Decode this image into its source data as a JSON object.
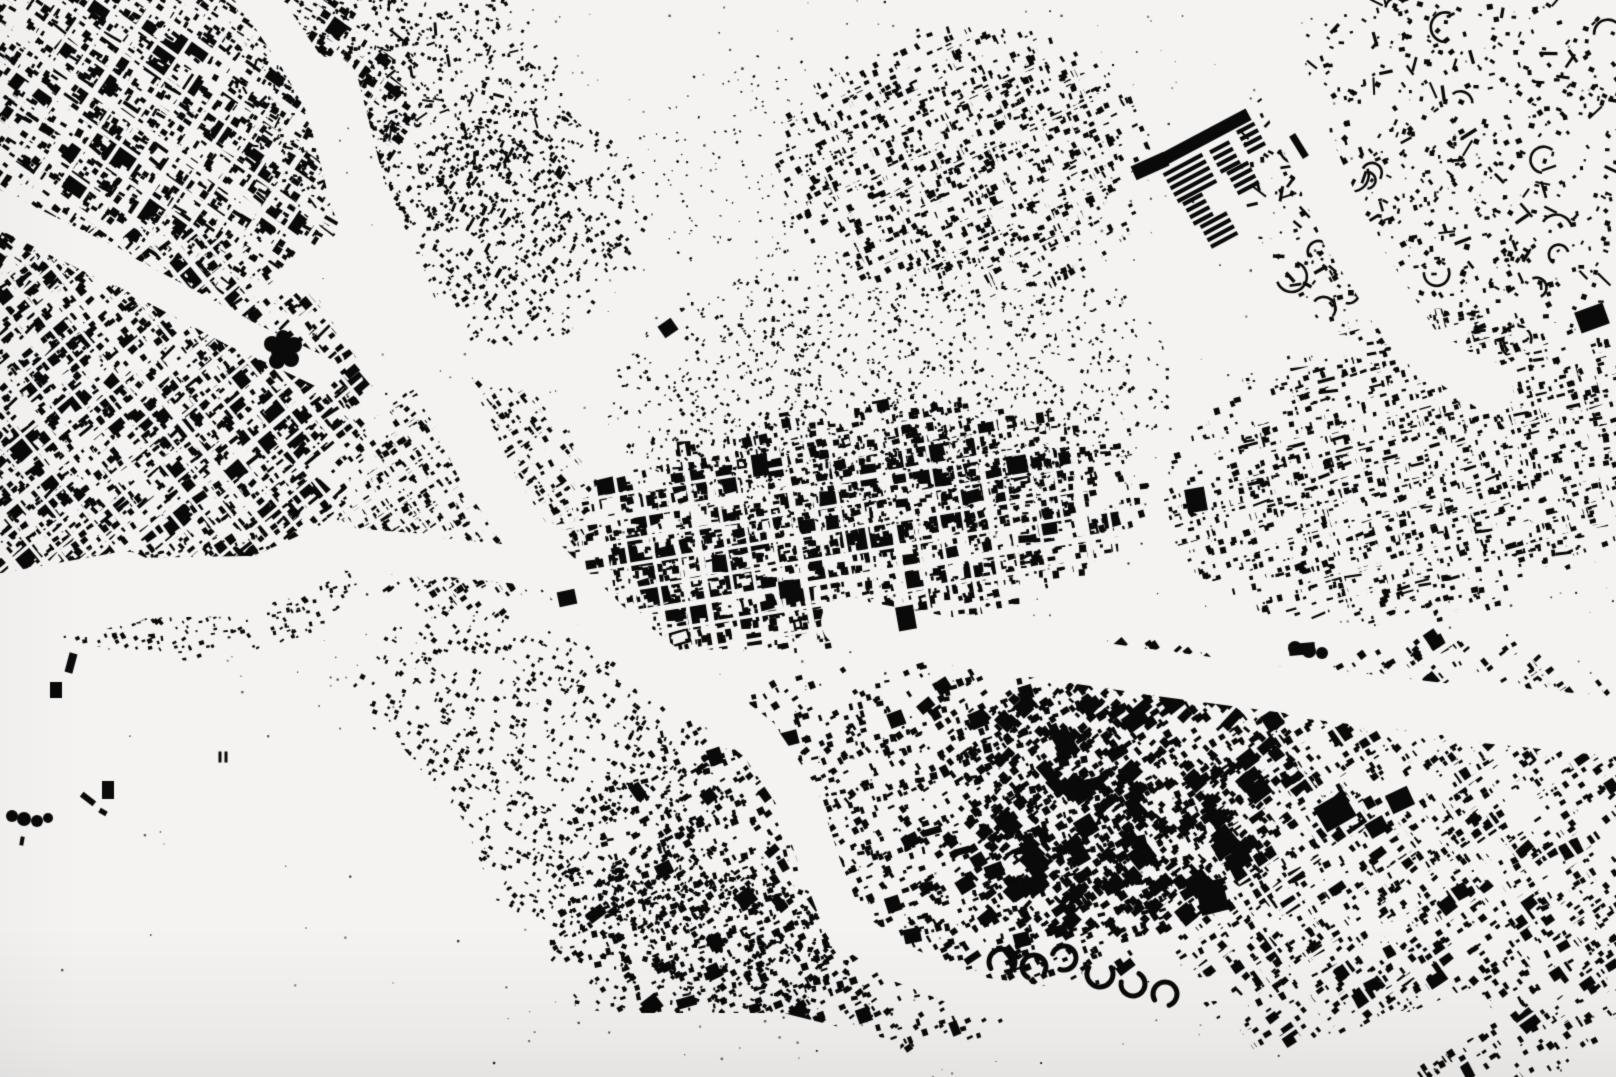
{
  "meta": {
    "content_type": "figure-ground-city-map",
    "visible_text": "none"
  },
  "canvas": {
    "width": 1616,
    "height": 1077
  },
  "colors": {
    "background": "#f4f3f2",
    "ink": "#0a0a0a"
  },
  "seed": 1337,
  "districts": [
    {
      "name": "old-town-northwest",
      "cx": 170,
      "cy": 115,
      "rx": 255,
      "ry": 180,
      "rot": -18,
      "angle": 35,
      "angle_jitter": 7,
      "count": 2300,
      "size_min": 2.5,
      "size_max": 8.5,
      "elong_chance": 0.1,
      "large_chance": 0.05,
      "large_size": 16,
      "streets": {
        "angles": [
          35,
          -55
        ],
        "spacing": 26,
        "width": 4,
        "main_every": 4,
        "main_width": 6.5
      }
    },
    {
      "name": "hillside-north",
      "cx": 400,
      "cy": 95,
      "rx": 170,
      "ry": 135,
      "rot": 15,
      "count": 1000,
      "size_min": 1.5,
      "size_max": 4.5,
      "elong_chance": 0.06
    },
    {
      "name": "old-town-west",
      "cx": 148,
      "cy": 425,
      "rx": 218,
      "ry": 198,
      "rot": 8,
      "angle": -40,
      "angle_jitter": 8,
      "count": 2100,
      "size_min": 2.5,
      "size_max": 8.5,
      "elong_chance": 0.08,
      "large_chance": 0.05,
      "large_size": 15,
      "streets": {
        "angles": [
          -40,
          50
        ],
        "spacing": 22,
        "width": 3.5,
        "main_every": 5,
        "main_width": 6
      }
    },
    {
      "name": "riverbank-west",
      "cx": 205,
      "cy": 598,
      "rx": 155,
      "ry": 62,
      "rot": -8,
      "angle": -20,
      "angle_jitter": 16,
      "count": 400,
      "size_min": 1.5,
      "size_max": 5
    },
    {
      "name": "center-west-wedge",
      "cx": 465,
      "cy": 500,
      "rx": 125,
      "ry": 122,
      "rot": 0,
      "angle": -35,
      "angle_jitter": 10,
      "count": 800,
      "size_min": 2,
      "size_max": 7,
      "streets": {
        "angles": [
          -35,
          55
        ],
        "spacing": 20,
        "width": 3,
        "main_every": 4,
        "main_width": 5
      }
    },
    {
      "name": "central-ribbon",
      "cx": 845,
      "cy": 528,
      "rx": 305,
      "ry": 118,
      "rot": -8,
      "angle": -10,
      "angle_jitter": 8,
      "count": 2400,
      "size_min": 2,
      "size_max": 8,
      "large_chance": 0.05,
      "large_size": 14,
      "hollow_chance": 0.05,
      "streets": {
        "angles": [
          -10,
          80
        ],
        "spacing": 24,
        "width": 3.5,
        "main_every": 4,
        "main_width": 6
      }
    },
    {
      "name": "hill-speckle",
      "cx": 893,
      "cy": 390,
      "rx": 285,
      "ry": 140,
      "rot": -4,
      "count": 1500,
      "size_min": 1.2,
      "size_max": 4
    },
    {
      "name": "north-center-blocks",
      "cx": 965,
      "cy": 163,
      "rx": 188,
      "ry": 138,
      "rot": 0,
      "angle": -25,
      "angle_jitter": 10,
      "count": 1150,
      "size_min": 2,
      "size_max": 7,
      "hollow_chance": 0.08,
      "streets": {
        "angles": [
          -25,
          65
        ],
        "spacing": 27,
        "width": 3,
        "main_every": 5,
        "main_width": 5
      }
    },
    {
      "name": "northeast-estates",
      "cx": 1458,
      "cy": 170,
      "rx": 218,
      "ry": 198,
      "count": 820,
      "size_min": 2,
      "size_max": 6,
      "elong_chance": 0.12,
      "arcs": 26
    },
    {
      "name": "east-mid-rows",
      "cx": 1420,
      "cy": 468,
      "rx": 258,
      "ry": 152,
      "rot": -12,
      "angle": -15,
      "angle_jitter": 9,
      "count": 1700,
      "size_min": 2,
      "size_max": 7,
      "elong_chance": 0.08,
      "streets": {
        "angles": [
          -15,
          75
        ],
        "spacing": 23,
        "width": 3,
        "main_every": 5,
        "main_width": 5
      }
    },
    {
      "name": "southeast-dense",
      "cx": 1432,
      "cy": 872,
      "rx": 272,
      "ry": 232,
      "rot": -15,
      "angle": -35,
      "angle_jitter": 9,
      "count": 1900,
      "size_min": 2,
      "size_max": 8,
      "large_chance": 0.06,
      "large_size": 15,
      "streets": {
        "angles": [
          -35,
          55
        ],
        "spacing": 25,
        "width": 3.2,
        "main_every": 5,
        "main_width": 5.5
      }
    },
    {
      "name": "south-center",
      "cx": 880,
      "cy": 860,
      "rx": 330,
      "ry": 195,
      "rot": -8,
      "angle": -25,
      "angle_jitter": 16,
      "count": 1900,
      "size_min": 2,
      "size_max": 7.5,
      "large_chance": 0.04,
      "large_size": 13
    },
    {
      "name": "south-center-east",
      "cx": 1120,
      "cy": 792,
      "rx": 185,
      "ry": 145,
      "rot": -20,
      "angle": -40,
      "angle_jitter": 10,
      "count": 1100,
      "size_min": 2.5,
      "size_max": 9,
      "large_chance": 0.08,
      "large_size": 16
    },
    {
      "name": "mid-south-hillside",
      "cx": 545,
      "cy": 775,
      "rx": 215,
      "ry": 132,
      "rot": 35,
      "angle": 30,
      "angle_jitter": 18,
      "count": 950,
      "size_min": 1.5,
      "size_max": 5
    },
    {
      "name": "south-village",
      "cx": 700,
      "cy": 950,
      "rx": 152,
      "ry": 95,
      "count": 600,
      "size_min": 1.8,
      "size_max": 5.5
    },
    {
      "name": "north-mid-speckle",
      "cx": 520,
      "cy": 228,
      "rx": 128,
      "ry": 118,
      "rot": -30,
      "angle": -40,
      "angle_jitter": 20,
      "count": 620,
      "size_min": 1.5,
      "size_max": 4.5
    },
    {
      "name": "southwest-sparse",
      "cx": 245,
      "cy": 950,
      "rx": 122,
      "ry": 62,
      "rot": 10,
      "count": 130,
      "size_min": 1.2,
      "size_max": 3.5
    },
    {
      "name": "valley-slabs",
      "cx": 505,
      "cy": 212,
      "rx": 98,
      "ry": 78,
      "rot": -40,
      "angle": -62,
      "angle_jitter": 8,
      "count": 55,
      "size_min": 2.5,
      "size_max": 3.5,
      "elong_chance": 1
    },
    {
      "name": "top-center-dust",
      "cx": 755,
      "cy": 165,
      "rx": 128,
      "ry": 112,
      "count": 160,
      "size_min": 1,
      "size_max": 2.8
    }
  ],
  "noise": {
    "global_count": 1000,
    "size": [
      0.8,
      2.4
    ],
    "void_speck_count": 90,
    "void_speck_rects": [
      [
        60,
        630,
        400,
        380
      ],
      [
        480,
        1000,
        400,
        68
      ],
      [
        560,
        45,
        250,
        245
      ],
      [
        300,
        90,
        170,
        360
      ],
      [
        980,
        120,
        160,
        120
      ]
    ]
  },
  "voids": {
    "strokes": [
      {
        "name": "river-upper-branch",
        "points": [
          [
            253,
            -10,
            40
          ],
          [
            300,
            60,
            38
          ],
          [
            338,
            128,
            40
          ]
        ]
      },
      {
        "name": "river-main",
        "points": [
          [
            330,
            85,
            55
          ],
          [
            358,
            195,
            60
          ],
          [
            404,
            298,
            57
          ],
          [
            450,
            398,
            55
          ],
          [
            488,
            478,
            50
          ],
          [
            538,
            554,
            46
          ],
          [
            608,
            623,
            44
          ],
          [
            688,
            685,
            46
          ],
          [
            758,
            739,
            44
          ],
          [
            798,
            798,
            42
          ],
          [
            818,
            858,
            40
          ],
          [
            844,
            925,
            40
          ],
          [
            899,
            963,
            38
          ],
          [
            973,
            993,
            36
          ],
          [
            1053,
            1004,
            32
          ],
          [
            1139,
            996,
            28
          ],
          [
            1219,
            988,
            22
          ]
        ]
      },
      {
        "name": "river-west-branch",
        "points": [
          [
            -10,
            612,
            80
          ],
          [
            125,
            588,
            66
          ],
          [
            248,
            586,
            54
          ],
          [
            332,
            548,
            46
          ],
          [
            430,
            556,
            40
          ],
          [
            520,
            565,
            36
          ]
        ]
      },
      {
        "name": "northwest-gap",
        "points": [
          [
            -10,
            205,
            38
          ],
          [
            118,
            268,
            34
          ],
          [
            238,
            332,
            32
          ],
          [
            322,
            372,
            30
          ]
        ]
      },
      {
        "name": "northeast-corridor",
        "points": [
          [
            1253,
            -10,
            54
          ],
          [
            1295,
            115,
            50
          ],
          [
            1348,
            238,
            48
          ],
          [
            1415,
            342,
            46
          ],
          [
            1492,
            392,
            40
          ]
        ]
      },
      {
        "name": "east-rail-corridor",
        "points": [
          [
            845,
            622,
            50
          ],
          [
            1000,
            650,
            46
          ],
          [
            1150,
            672,
            44
          ],
          [
            1300,
            692,
            48
          ],
          [
            1468,
            712,
            56
          ],
          [
            1626,
            728,
            62
          ]
        ]
      },
      {
        "name": "southeast-gap",
        "points": [
          [
            1316,
            1085,
            70
          ],
          [
            1400,
            1042,
            55
          ],
          [
            1468,
            1014,
            40
          ]
        ]
      }
    ],
    "polygons": [
      {
        "name": "bottom-left-open",
        "points": [
          [
            -10,
            635
          ],
          [
            150,
            652
          ],
          [
            300,
            690
          ],
          [
            398,
            742
          ],
          [
            462,
            818
          ],
          [
            498,
            905
          ],
          [
            492,
            1010
          ],
          [
            470,
            1085
          ],
          [
            -10,
            1085
          ]
        ]
      },
      {
        "name": "bottom-strip-open",
        "points": [
          [
            438,
            995
          ],
          [
            620,
            1013
          ],
          [
            783,
            1013
          ],
          [
            900,
            1042
          ],
          [
            903,
            1085
          ],
          [
            438,
            1085
          ]
        ]
      }
    ]
  },
  "landmarks": {
    "stripe_complex": {
      "angle": -28,
      "gap": 7.4,
      "thickness": 4.2,
      "bars": [
        [
          1200,
          140,
          110,
          13,
          -28
        ],
        [
          1150,
          166,
          36,
          15,
          -24
        ],
        [
          1299,
          146,
          26,
          7,
          58
        ]
      ],
      "stripe_groups": [
        [
          1190,
          178,
          44,
          5
        ],
        [
          1225,
          157,
          22,
          4
        ],
        [
          1251,
          138,
          20,
          4
        ],
        [
          1243,
          178,
          24,
          4
        ],
        [
          1198,
          209,
          22,
          4
        ],
        [
          1219,
          230,
          30,
          4
        ]
      ]
    },
    "blobs": [
      [
        567,
        598,
        18,
        15,
        -12
      ],
      [
        790,
        589,
        22,
        17,
        -8
      ],
      [
        906,
        618,
        18,
        24,
        -10
      ],
      [
        1196,
        500,
        20,
        24,
        -10
      ],
      [
        1302,
        649,
        26,
        12,
        -5
      ],
      [
        1335,
        812,
        34,
        28,
        -30
      ],
      [
        1377,
        827,
        20,
        16,
        -30
      ],
      [
        1400,
        800,
        24,
        20,
        -25
      ],
      [
        1212,
        897,
        28,
        32,
        -14
      ],
      [
        760,
        465,
        16,
        22,
        -8
      ],
      [
        1592,
        318,
        30,
        22,
        -20
      ],
      [
        668,
        328,
        16,
        14,
        -35
      ],
      [
        71,
        663,
        8,
        20,
        15
      ],
      [
        56,
        690,
        12,
        16,
        0
      ],
      [
        108,
        790,
        12,
        18,
        0
      ],
      [
        88,
        799,
        16,
        6,
        38
      ],
      [
        220,
        757,
        3,
        11,
        0
      ],
      [
        226,
        757,
        3,
        11,
        0
      ],
      [
        22,
        841,
        4,
        9,
        10
      ],
      [
        103,
        812,
        8,
        5,
        30
      ]
    ],
    "blob_circles": [
      [
        283,
        351,
        12
      ],
      [
        272,
        344,
        8
      ],
      [
        294,
        345,
        8
      ],
      [
        277,
        361,
        8
      ],
      [
        291,
        359,
        8
      ],
      [
        283,
        337,
        7
      ],
      [
        1295,
        648,
        7
      ],
      [
        1309,
        651,
        7
      ],
      [
        1322,
        653,
        6
      ],
      [
        12,
        816,
        6
      ],
      [
        24,
        819,
        7
      ],
      [
        37,
        821,
        6
      ],
      [
        48,
        818,
        5
      ]
    ],
    "arc_buildings": [
      [
        1002,
        962,
        13,
        150,
        420,
        5
      ],
      [
        1034,
        967,
        12,
        120,
        390,
        5
      ],
      [
        1064,
        958,
        12,
        200,
        470,
        5
      ],
      [
        1100,
        974,
        13,
        -30,
        210,
        5
      ],
      [
        1133,
        984,
        12,
        -60,
        190,
        5
      ],
      [
        1165,
        994,
        12,
        150,
        430,
        5
      ]
    ]
  }
}
